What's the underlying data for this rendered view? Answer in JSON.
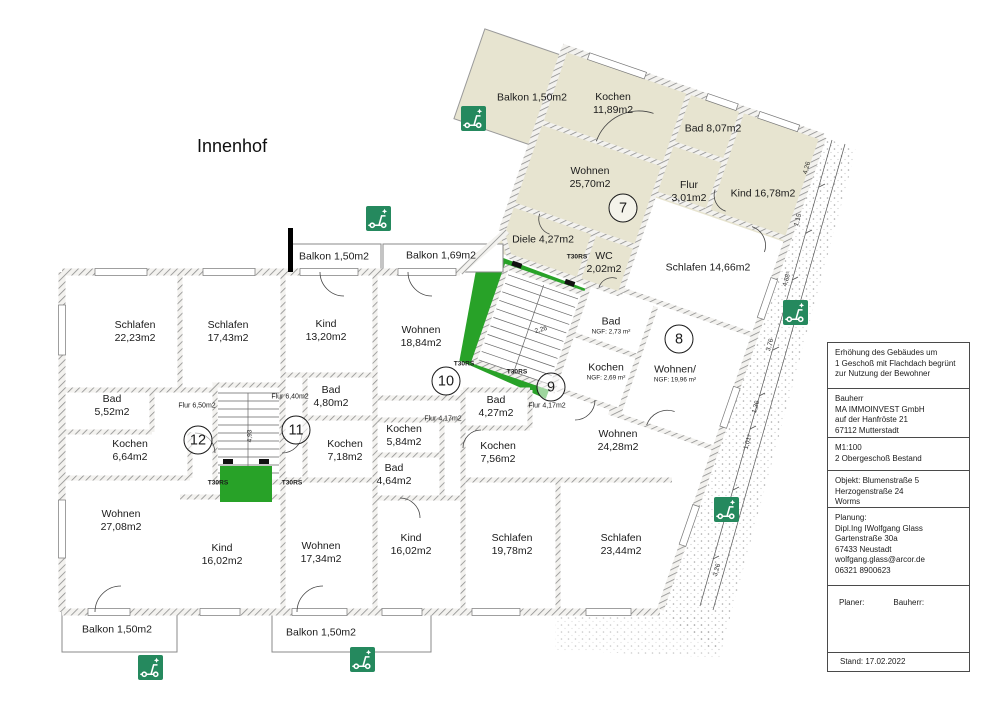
{
  "innenhof_label": "Innenhof",
  "colors": {
    "apartment7_fill": "#e7e4d0",
    "stair_green": "#28a228",
    "sign_green": "#25895e",
    "hatch_line": "#8d8d8d"
  },
  "rooms": [
    {
      "name": "Schlafen",
      "area": "22,23m2",
      "x": 135,
      "y": 332
    },
    {
      "name": "Schlafen",
      "area": "17,43m2",
      "x": 228,
      "y": 332
    },
    {
      "name": "Kind",
      "area": "13,20m2",
      "x": 326,
      "y": 331
    },
    {
      "name": "Wohnen",
      "area": "18,84m2",
      "x": 421,
      "y": 337
    },
    {
      "name": "Bad",
      "area": "5,52m2",
      "x": 112,
      "y": 406
    },
    {
      "name": "Flur 6,50m2",
      "x": 197,
      "y": 407,
      "small": true
    },
    {
      "name": "Kochen",
      "area": "6,64m2",
      "x": 130,
      "y": 451
    },
    {
      "name": "Flur 6,40m2",
      "x": 290,
      "y": 398,
      "small": true
    },
    {
      "name": "Bad",
      "area": "4,80m2",
      "x": 331,
      "y": 397
    },
    {
      "name": "Kochen",
      "area": "7,18m2",
      "x": 345,
      "y": 451
    },
    {
      "name": "Kochen",
      "area": "5,84m2",
      "x": 404,
      "y": 436
    },
    {
      "name": "Bad",
      "area": "4,64m2",
      "x": 394,
      "y": 475
    },
    {
      "name": "Flur 4,17m2",
      "x": 443,
      "y": 420,
      "small": true
    },
    {
      "name": "Bad",
      "area": "4,27m2",
      "x": 496,
      "y": 407
    },
    {
      "name": "Flur 4,17m2",
      "x": 547,
      "y": 407,
      "small": true
    },
    {
      "name": "Kochen",
      "area": "7,56m2",
      "x": 498,
      "y": 453
    },
    {
      "name": "Wohnen",
      "area": "24,28m2",
      "x": 618,
      "y": 441
    },
    {
      "name": "Wohnen",
      "area": "27,08m2",
      "x": 121,
      "y": 521
    },
    {
      "name": "Kind",
      "area": "16,02m2",
      "x": 222,
      "y": 555
    },
    {
      "name": "Wohnen",
      "area": "17,34m2",
      "x": 321,
      "y": 553
    },
    {
      "name": "Kind",
      "area": "16,02m2",
      "x": 411,
      "y": 545
    },
    {
      "name": "Schlafen",
      "area": "19,78m2",
      "x": 512,
      "y": 545
    },
    {
      "name": "Schlafen",
      "area": "23,44m2",
      "x": 621,
      "y": 545
    },
    {
      "name": "Balkon 1,50m2",
      "x": 334,
      "y": 257
    },
    {
      "name": "Balkon 1,69m2",
      "x": 441,
      "y": 256
    },
    {
      "name": "Balkon 1,50m2",
      "x": 117,
      "y": 630
    },
    {
      "name": "Balkon 1,50m2",
      "x": 321,
      "y": 633
    },
    {
      "name": "Balkon 1,50m2",
      "x": 532,
      "y": 98
    },
    {
      "name": "Kochen",
      "area": "11,89m2",
      "x": 613,
      "y": 104
    },
    {
      "name": "Bad 8,07m2",
      "x": 713,
      "y": 129
    },
    {
      "name": "Wohnen",
      "area": "25,70m2",
      "x": 590,
      "y": 178
    },
    {
      "name": "Flur",
      "area": "3,01m2",
      "x": 689,
      "y": 192
    },
    {
      "name": "Kind 16,78m2",
      "x": 763,
      "y": 194
    },
    {
      "name": "Diele 4,27m2",
      "x": 543,
      "y": 240
    },
    {
      "name": "WC",
      "area": "2,02m2",
      "x": 604,
      "y": 263
    },
    {
      "name": "Schlafen 14,66m2",
      "x": 708,
      "y": 268
    },
    {
      "name": "Bad",
      "sub": "NGF: 2,73 m²",
      "x": 611,
      "y": 326
    },
    {
      "name": "Kochen",
      "sub": "NGF: 2,69 m²",
      "x": 606,
      "y": 372
    },
    {
      "name": "Wohnen/",
      "sub": "NGF: 19,96 m²",
      "x": 675,
      "y": 374
    }
  ],
  "unit_circles": [
    {
      "number": "7",
      "x": 623,
      "y": 208
    },
    {
      "number": "8",
      "x": 679,
      "y": 339
    },
    {
      "number": "9",
      "x": 551,
      "y": 387
    },
    {
      "number": "10",
      "x": 446,
      "y": 381
    },
    {
      "number": "11",
      "x": 296,
      "y": 430
    },
    {
      "number": "12",
      "x": 198,
      "y": 440
    }
  ],
  "fire_door_labels": [
    {
      "text": "T30RS",
      "x": 218,
      "y": 483
    },
    {
      "text": "T30RS",
      "x": 292,
      "y": 483
    },
    {
      "text": "T30RS",
      "x": 577,
      "y": 257
    },
    {
      "text": "T30RS",
      "x": 464,
      "y": 364
    },
    {
      "text": "T30RS",
      "x": 517,
      "y": 372
    }
  ],
  "dimensions": [
    {
      "text": "4,26",
      "x": 807,
      "y": 168,
      "rotate": -74
    },
    {
      "text": "1,15",
      "x": 798,
      "y": 220,
      "rotate": -74
    },
    {
      "text": "4,88⁵",
      "x": 787,
      "y": 279,
      "rotate": -74
    },
    {
      "text": "3,76",
      "x": 770,
      "y": 345,
      "rotate": -74
    },
    {
      "text": "1,36",
      "x": 756,
      "y": 407,
      "rotate": -74
    },
    {
      "text": "1,01⁵",
      "x": 748,
      "y": 442,
      "rotate": -74
    },
    {
      "text": "3,88⁵",
      "x": 734,
      "y": 506,
      "rotate": -74
    },
    {
      "text": "3,26",
      "x": 717,
      "y": 570,
      "rotate": -74
    },
    {
      "text": "2,26",
      "x": 541,
      "y": 330,
      "rotate": -16
    },
    {
      "text": "4,93",
      "x": 250,
      "y": 436,
      "rotate": -90
    }
  ],
  "sign_icons": [
    {
      "name": "scooter-sign",
      "x": 461,
      "y": 106
    },
    {
      "name": "scooter-sign",
      "x": 366,
      "y": 206
    },
    {
      "name": "scooter-sign",
      "x": 783,
      "y": 300
    },
    {
      "name": "scooter-sign",
      "x": 714,
      "y": 497
    },
    {
      "name": "scooter-sign",
      "x": 138,
      "y": 655
    },
    {
      "name": "scooter-sign",
      "x": 350,
      "y": 647
    }
  ],
  "title_block": {
    "sections": [
      {
        "lines": [
          "Erhöhung des Gebäudes um",
          "1 Geschoß mit Flachdach begrünt",
          "zur Nutzung der Bewohner"
        ]
      },
      {
        "lines": [
          "Bauherr",
          "MA IMMOINVEST GmbH",
          "auf der Hanfröste 21",
          "67112 Mutterstadt"
        ]
      },
      {
        "lines": [
          "M1:100",
          "2 Obergeschoß Bestand"
        ]
      },
      {
        "lines": [
          "Objekt: Blumenstraße 5",
          "Herzogenstraße 24",
          "Worms"
        ]
      },
      {
        "lines": [
          "Planung:",
          "Dipl.Ing IWolfgang Glass",
          "Gartenstraße 30a",
          "67433 Neustadt",
          "wolfgang.glass@arcor.de",
          "06321 8900623"
        ]
      },
      {
        "lines": [
          "Planer:",
          "Bauherr:"
        ],
        "cols": true
      },
      {
        "lines": [
          "Stand: 17.02.2022"
        ]
      }
    ]
  }
}
